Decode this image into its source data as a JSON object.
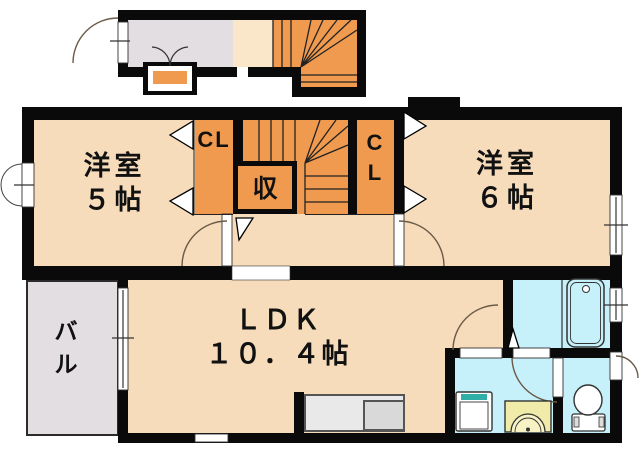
{
  "title": "2LDK maisonette floor plan",
  "labels": {
    "room5": "洋室\n５帖",
    "room6": "洋室\n６帖",
    "ldk": "ＬＤＫ\n１０．４帖",
    "closet_left": "CL",
    "closet_right": "C\nL",
    "storage": "収",
    "balcony": "バ\nル"
  },
  "palette": {
    "wall": "#0a0a0a",
    "room_floor": "#f6dcba",
    "stairs_closet": "#ef9a4f",
    "entrance_balcony": "#e2dee2",
    "wet_area": "#c6f0fa",
    "vanity": "#f0eba8",
    "washer_tray_accent": "#2fafa6"
  }
}
